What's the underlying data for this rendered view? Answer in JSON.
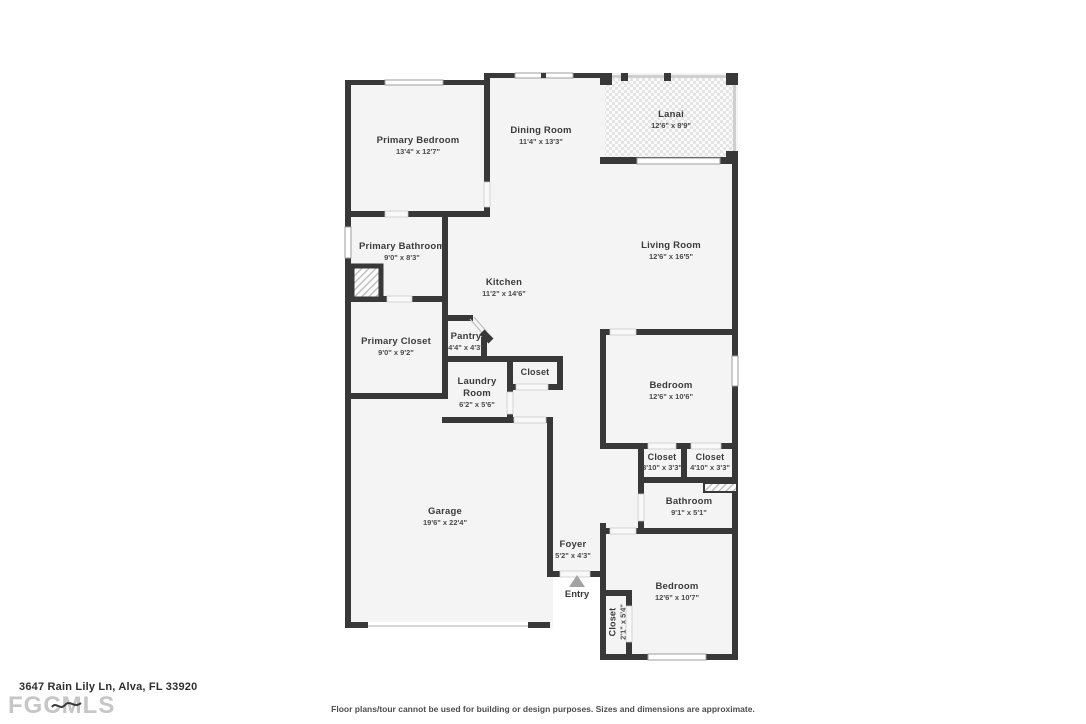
{
  "fp": {
    "address": "3647 Rain Lily Ln, Alva, FL 33920",
    "brand": "FGCMLS",
    "disclaimer": "Floor plans/tour cannot be used for building or design purposes. Sizes and dimensions are approximate.",
    "entry_label": "Entry",
    "colors": {
      "wall": "#383838",
      "floor": "#f4f4f4",
      "text": "#3b3b3b",
      "lanai_dot": "#e4e4e4",
      "entry_arrow": "#a3a3a3"
    },
    "rooms": [
      {
        "name": "Primary Bedroom",
        "dims": "13'4\" x 12'7\""
      },
      {
        "name": "Dining Room",
        "dims": "11'4\" x 13'3\""
      },
      {
        "name": "Lanai",
        "dims": "12'6\" x 8'9\""
      },
      {
        "name": "Living Room",
        "dims": "12'6\" x 16'5\""
      },
      {
        "name": "Primary Bathroom",
        "dims": "9'0\" x 8'3\""
      },
      {
        "name": "Kitchen",
        "dims": "11'2\" x 14'6\""
      },
      {
        "name": "Primary Closet",
        "dims": "9'0\" x 9'2\""
      },
      {
        "name": "Pantry",
        "dims": "4'4\" x 4'3\""
      },
      {
        "name": "Closet"
      },
      {
        "name": "Laundry Room",
        "dims": "6'2\" x 5'6\""
      },
      {
        "name": "Bedroom",
        "dims": "12'6\" x 10'6\""
      },
      {
        "name": "Closet",
        "dims": "3'10\" x 3'3\""
      },
      {
        "name": "Closet",
        "dims": "4'10\" x 3'3\""
      },
      {
        "name": "Bathroom",
        "dims": "9'1\" x 5'1\""
      },
      {
        "name": "Garage",
        "dims": "19'6\" x 22'4\""
      },
      {
        "name": "Foyer",
        "dims": "5'2\" x 4'3\""
      },
      {
        "name": "Bedroom",
        "dims": "12'6\" x 10'7\""
      },
      {
        "name": "Closet",
        "dims": "2'1\" x 5'4\""
      }
    ]
  }
}
